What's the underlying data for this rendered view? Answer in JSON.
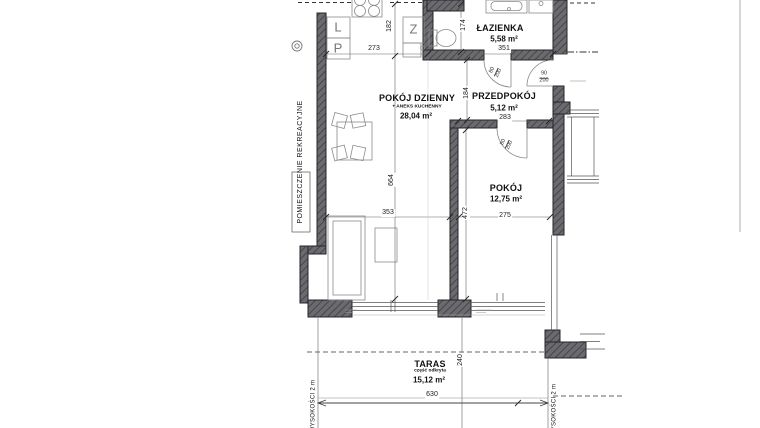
{
  "plan": {
    "rooms": [
      {
        "key": "lazienka",
        "name": "ŁAZIENKA",
        "area": "5,58 m²"
      },
      {
        "key": "przedpokoj",
        "name": "PRZEDPOKÓJ",
        "area": "5,12 m²"
      },
      {
        "key": "pokoj-dzienny",
        "name": "POKÓJ DZIENNY",
        "subtitle": "+ ANEKS KUCHENNY",
        "area": "28,04 m²"
      },
      {
        "key": "pokoj",
        "name": "POKÓJ",
        "area": "12,75 m²"
      },
      {
        "key": "taras",
        "name": "TARAS",
        "subtitle": "część odkryta",
        "area": "15,12 m²"
      }
    ],
    "side_labels": {
      "recreation": "POMIESZCZENIE REKREACYJNE",
      "height_left": "WYSOKOŚCI 2 m",
      "height_right": "WYSOKOŚCI 2 m"
    },
    "kitchen_symbols": {
      "l": "L",
      "p": "P",
      "z": "Z"
    },
    "dimensions": {
      "kitchen_width": "273",
      "kitchen_depth": "182",
      "bathroom_width": "351",
      "bathroom_side": "174",
      "hall_width": "283",
      "hall_depth": "184",
      "living_width": "353",
      "living_depth": "664",
      "room_width": "275",
      "room_depth": "472",
      "terrace_width": "630",
      "terrace_depth": "240"
    },
    "door_labels": [
      {
        "location": "bathroom",
        "width": "80",
        "height": "200"
      },
      {
        "location": "hall",
        "width": "90",
        "height": "200"
      },
      {
        "location": "room",
        "width": "80",
        "height": "200"
      }
    ]
  }
}
